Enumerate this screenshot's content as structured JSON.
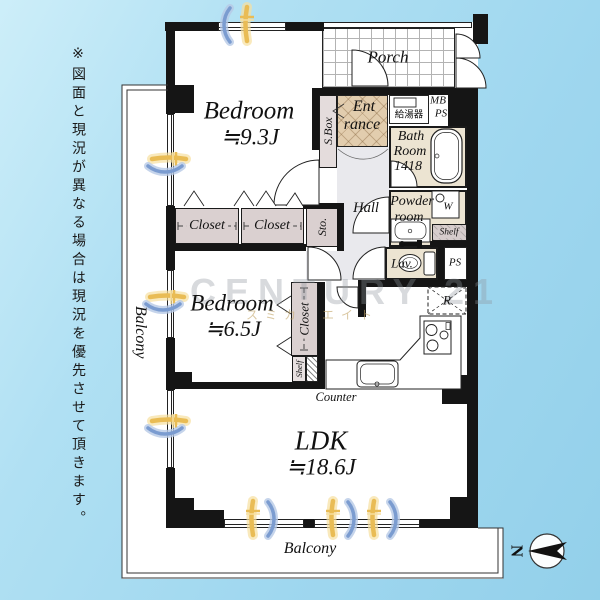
{
  "watermark": {
    "brand": "CENTURY 21",
    "company": "スミカ・エイト"
  },
  "disclaimer": "※図面と現況が異なる場合は現況を優先させて頂きます。",
  "compass": {
    "north_label": "N"
  },
  "rooms": {
    "bedroom_main": {
      "name": "Bedroom",
      "size": "≒9.3J"
    },
    "bedroom_second": {
      "name": "Bedroom",
      "size": "≒6.5J"
    },
    "ldk": {
      "name": "LDK",
      "size": "≒18.6J"
    },
    "porch": {
      "label": "Porch"
    },
    "entrance": {
      "line1": "Ent",
      "line2": "rance"
    },
    "bathroom": {
      "line1": "Bath",
      "line2": "Room",
      "line3": "1418"
    },
    "powder_room": {
      "line1": "Powder",
      "line2": "room"
    },
    "lavatory": {
      "label": "Lav."
    },
    "hall": {
      "label": "Hall"
    }
  },
  "fixtures": {
    "shoe_box": "S.Box",
    "storage": "Sto.",
    "closet_a": "Closet",
    "closet_b": "Closet",
    "closet_c": "Closet",
    "shelf_powder": "Shelf",
    "shelf_bedroom": "Shelf",
    "washer": "W",
    "refrigerator": "R",
    "counter": "Counter",
    "water_heater": "給湯器",
    "meter_box": "MB",
    "pipe_space_upper": "PS",
    "pipe_space_lower": "PS"
  },
  "balconies": {
    "left": "Balcony",
    "bottom": "Balcony"
  },
  "colors": {
    "background_blue": "#a5daf0",
    "wall": "#151515",
    "wet_room_cream": "#ece4d2",
    "entrance_tile": "#e2cdae",
    "closet_fill": "#dad0d0",
    "hall_gray": "#e9e9ed",
    "charm_yellow": "#e9bc55",
    "charm_blue": "#7b9cd0",
    "watermark_gray": "#8e959d"
  }
}
